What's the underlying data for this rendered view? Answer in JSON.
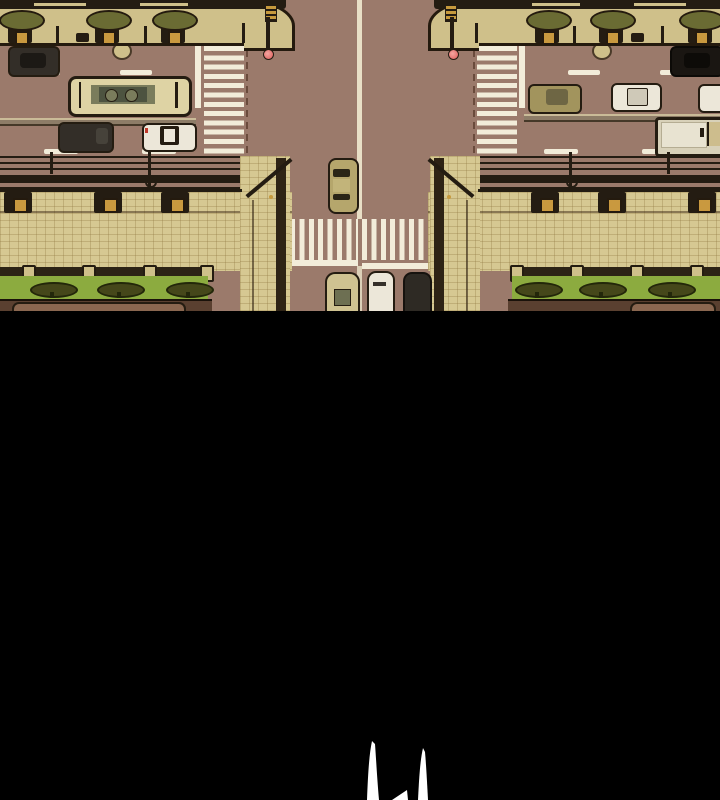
{
  "panel": {
    "type": "webtoon-comic-panel",
    "setting": "top-down aerial view of a city street intersection with mirrored left/right symmetry",
    "gutter": "solid black lower portion of panel",
    "sfx_glyph": "partial white hand-drawn strokes emerging at bottom center"
  },
  "scene": {
    "roads": [
      "horizontal-street-top",
      "vertical-street-center"
    ],
    "crosswalks": [
      "left-vertical-crossing",
      "right-vertical-crossing",
      "center-horizontal-crossing"
    ],
    "vehicles_left_street": [
      "dark-sedan",
      "cream-bus",
      "dark-sedan-2",
      "white-police-car"
    ],
    "vehicles_right_street": [
      "black-sedan",
      "olive-sedan",
      "white-sedan",
      "white-sedan-partial",
      "box-truck"
    ],
    "vehicles_center_road": [
      "tan-car-northbound",
      "tan-van-waiting",
      "white-van-waiting",
      "dark-car-waiting"
    ],
    "street_furniture": [
      "planter-trees",
      "bollards",
      "manhole-covers",
      "corner-traffic-signals",
      "overhead-power-lines",
      "shop-sign-boxes",
      "green-awnings-with-tree-print",
      "storefront-counters"
    ]
  },
  "palette": {
    "black": "#000000",
    "road": "#9b7a6b",
    "sidewalk": "#cfc08a",
    "tiles": "#d6c892",
    "outline": "#241c11",
    "curb": "#241a0e",
    "wire": "#241c12",
    "white_paint": "#f2ecd9",
    "center_line": "#e8dfc6",
    "green": "#8cab3f",
    "tree_dark": "#45471a",
    "tree_line": "#23270a",
    "canopy": "#6a6b33",
    "hole": "#c9993f",
    "cream": "#ded3a4",
    "bus_band": "#7a7c5c",
    "bus_panel": "#4d5340",
    "white_car": "#ece7d9",
    "dark_car": "#332e28",
    "black_car": "#1a1612",
    "olive_car": "#a2945d",
    "tan_car": "#b5a66c",
    "van_tan": "#cfc291",
    "dark_van": "#2e2a24",
    "truck_body": "#d8d1b9",
    "truck_cargo": "#e8e3d1",
    "storefront": "#5a4030",
    "store_table": "#8a6750",
    "red_light": "#e4716e",
    "gold": "#c79a3d",
    "pillar": "#2e2315",
    "glyph": "#ffffff"
  }
}
